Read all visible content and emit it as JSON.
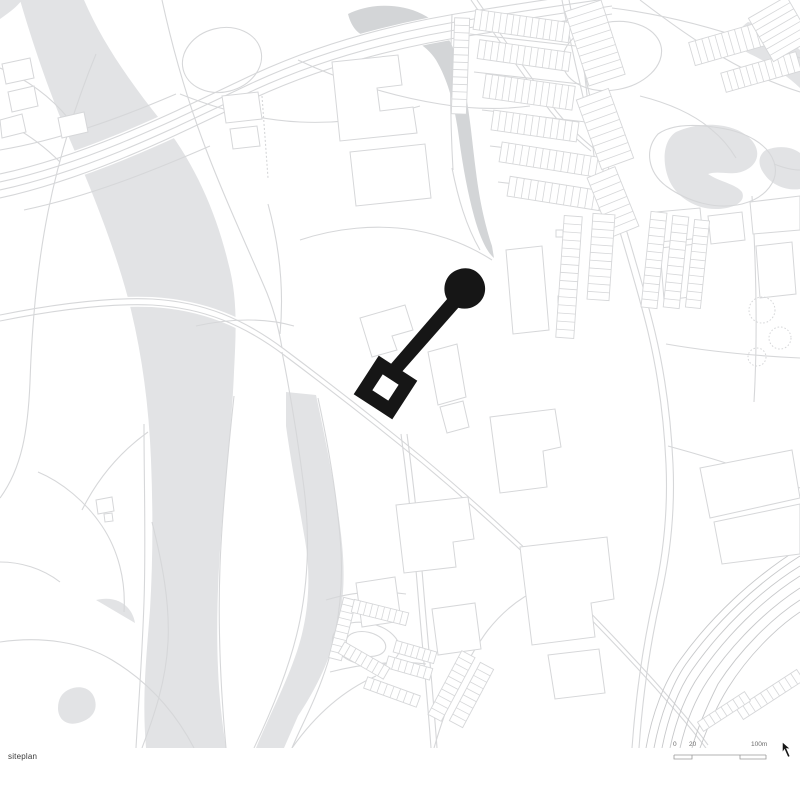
{
  "sheet": {
    "caption": "siteplan"
  },
  "scalebar": {
    "label_0": "0",
    "label_20": "20",
    "label_100": "100m"
  },
  "icons": {
    "north_arrow": "north-arrow-icon"
  },
  "colors": {
    "site": "#161616",
    "water": "#e2e3e5",
    "water-dark": "#d3d5d7",
    "line": "#d6d7d9",
    "line-dark": "#c7c8ca",
    "text": "#3a3a3a",
    "bg": "#ffffff"
  },
  "map": {
    "features": [
      "river",
      "canal",
      "pond",
      "park",
      "streets",
      "motorway-interchange",
      "terraced-housing",
      "railway",
      "parking",
      "site-building-marker"
    ]
  }
}
